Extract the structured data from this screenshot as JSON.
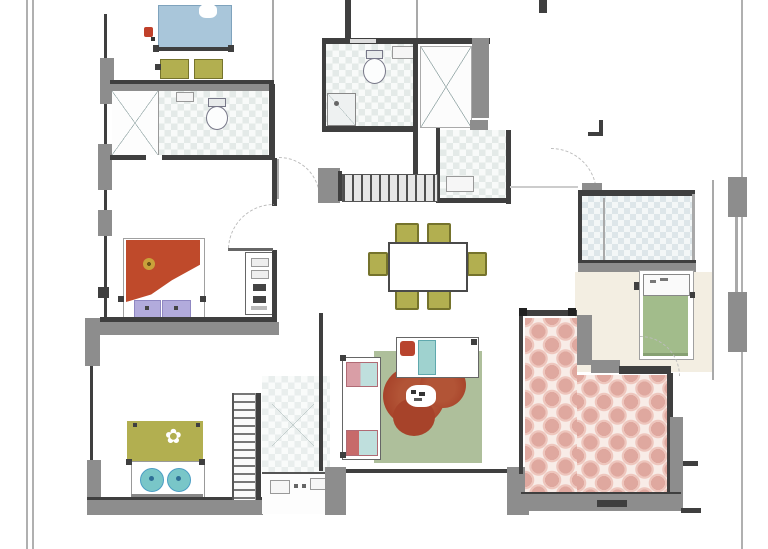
{
  "document_type": "apartment-floor-plan-drawing",
  "visible_text": [],
  "colors": {
    "wall_dark": "#3f3f3f",
    "wall_gray": "#8d8d8d",
    "line_light": "#a9a9a9",
    "bed_blue": "#a9c6da",
    "olive": "#b2af50",
    "olive_dark": "#75732c",
    "red_blanket": "#bf4a2b",
    "lavender": "#b2abdc",
    "teal_pillow": "#79c6c8",
    "rug_green": "#aebf9b",
    "blob_red": "#a7432a",
    "bed_green": "#a2bc8b",
    "pink_tile": "#dfa89f",
    "pink_bg": "#f8ece7",
    "floor_beige": "#f3eee2",
    "check_a": "#e4eae8",
    "check_b": "#f8faf9",
    "sofa_pink": "#d99ea6",
    "sofa_teal": "#bfdfdd",
    "gold": "#c9a23a"
  },
  "plan": {
    "rooms": [
      {
        "id": "bedroom-top-left",
        "furniture": [
          "double-bed-blue",
          "bench",
          "bench"
        ]
      },
      {
        "id": "bathroom-top-left",
        "furniture": [
          "wardrobe-x",
          "toilet",
          "sink"
        ]
      },
      {
        "id": "bedroom-middle-left",
        "furniture": [
          "double-bed-red",
          "pillows",
          "dresser"
        ]
      },
      {
        "id": "bedroom-bottom-left",
        "furniture": [
          "double-bed-olive",
          "pillows"
        ]
      },
      {
        "id": "entry-hall",
        "furniture": [
          "stairs",
          "tiled-floor"
        ]
      },
      {
        "id": "bathroom-center",
        "furniture": [
          "toilet",
          "shower",
          "sink"
        ]
      },
      {
        "id": "closet-center",
        "furniture": [
          "wardrobe-x"
        ]
      },
      {
        "id": "utility-room-center",
        "furniture": [
          "counter-unit"
        ]
      },
      {
        "id": "dining-area",
        "furniture": [
          "table",
          "chairs-x6"
        ]
      },
      {
        "id": "living-room",
        "furniture": [
          "sofa-vertical",
          "sofa-horizontal",
          "rug",
          "floor-cushion"
        ]
      },
      {
        "id": "bathroom-right",
        "furniture": [
          "tiled-floor"
        ]
      },
      {
        "id": "bedroom-right",
        "furniture": [
          "single-bed-green"
        ]
      },
      {
        "id": "terrace",
        "furniture": [
          "pink-tiled-floor"
        ]
      }
    ]
  }
}
